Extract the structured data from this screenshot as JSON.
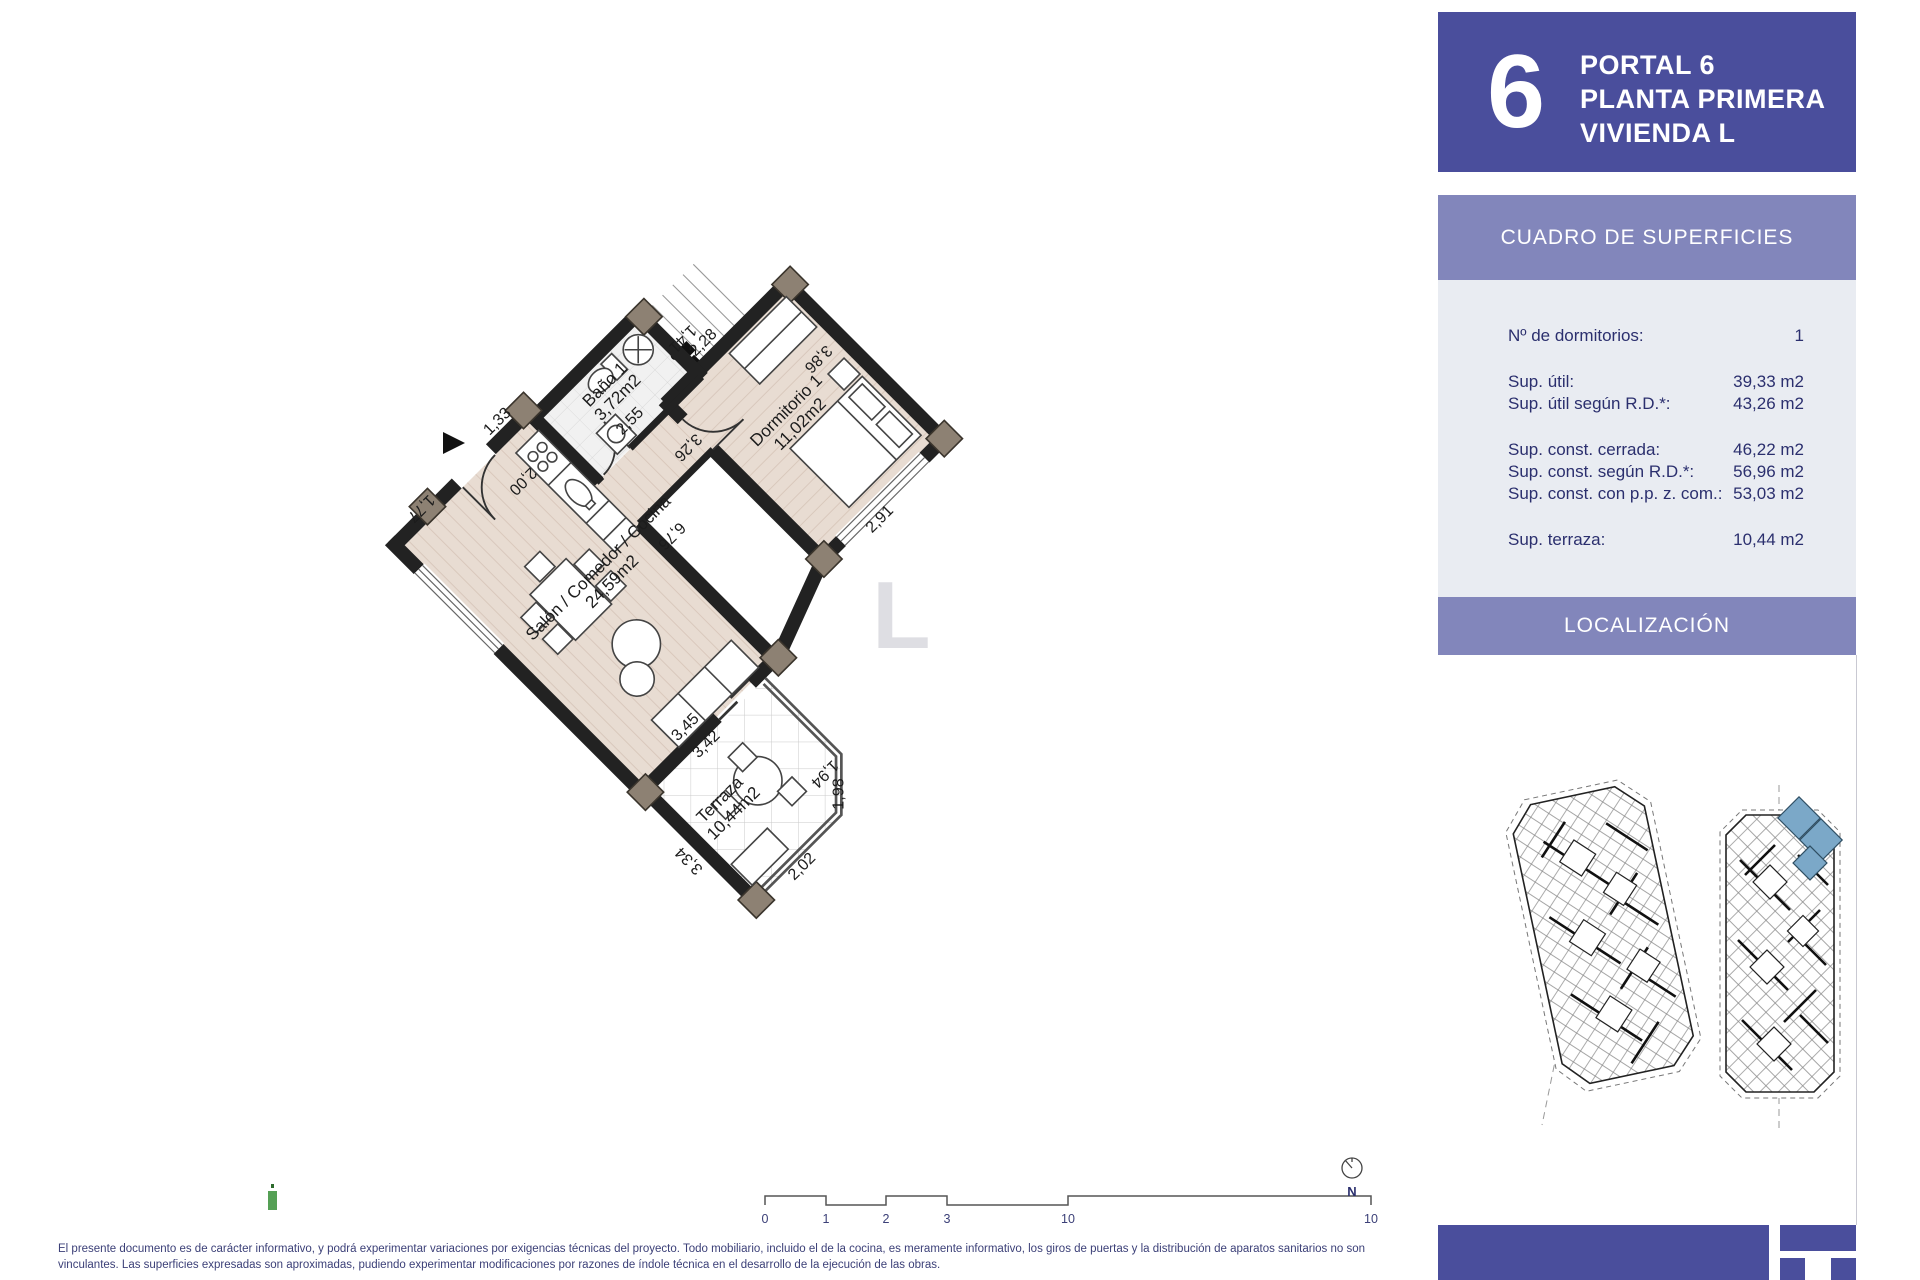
{
  "header": {
    "portal_number": "6",
    "line1": "PORTAL 6",
    "line2": "PLANTA PRIMERA",
    "line3": "VIVIENDA L"
  },
  "surfaces": {
    "title": "CUADRO DE SUPERFICIES",
    "rows": [
      {
        "label": "Nº de dormitorios:",
        "value": "1"
      },
      {
        "label": "Sup. útil:",
        "value": "39,33 m2"
      },
      {
        "label": "Sup. útil según R.D.*:",
        "value": "43,26 m2"
      },
      {
        "label": "Sup. const. cerrada:",
        "value": "46,22 m2"
      },
      {
        "label": "Sup. const. según R.D.*:",
        "value": "56,96 m2"
      },
      {
        "label": "Sup. const. con p.p. z. com.:",
        "value": "53,03 m2"
      },
      {
        "label": "Sup. terraza:",
        "value": "10,44 m2"
      }
    ]
  },
  "localizacion": {
    "title": "LOCALIZACIÓN"
  },
  "plan": {
    "rooms": [
      {
        "name": "Baño 1",
        "area": "3,72m2"
      },
      {
        "name": "Dormitorio 1",
        "area": "11,02m2"
      },
      {
        "name": "Salón / Comedor / Cocina",
        "area": "24,59m2"
      },
      {
        "name": "Terraza",
        "area": "10,44m2"
      }
    ],
    "dims": {
      "d141": "1,41",
      "d255": "2,55",
      "d200": "2,00",
      "d228": "2,28",
      "d386": "3,86",
      "d326": "3,26",
      "d291": "2,91",
      "d676": "6,76",
      "d133": "1,33",
      "d177": "1,77",
      "d345": "3,45",
      "d342": "3,42",
      "d194": "1,94",
      "d198": "1,98",
      "d202": "2,02",
      "d334": "3,34"
    },
    "watermark": "L"
  },
  "scalebar": {
    "labels": [
      "0",
      "1",
      "2",
      "3",
      "5",
      "10"
    ]
  },
  "compass": {
    "label": "N"
  },
  "footer": {
    "disclaimer_line1": "El presente documento es de carácter informativo, y podrá experimentar variaciones por exigencias técnicas del proyecto. Todo mobiliario, incluido el de la cocina, es meramente informativo, los giros de puertas y la distribución de aparatos sanitarios no son",
    "disclaimer_line2": "vinculantes. Las superficies expresadas son aproximadas, pudiendo experimentar modificaciones por razones de índole técnica en el desarrollo de la ejecución de las obras."
  },
  "colors": {
    "header_blue": "#4a4e9c",
    "band_purple": "#8286bb",
    "table_bg": "#e9ecf2",
    "navy_text": "#2b2f6e",
    "highlight_unit": "#7ba8c8",
    "floor_beige": "#e8dcd2"
  }
}
